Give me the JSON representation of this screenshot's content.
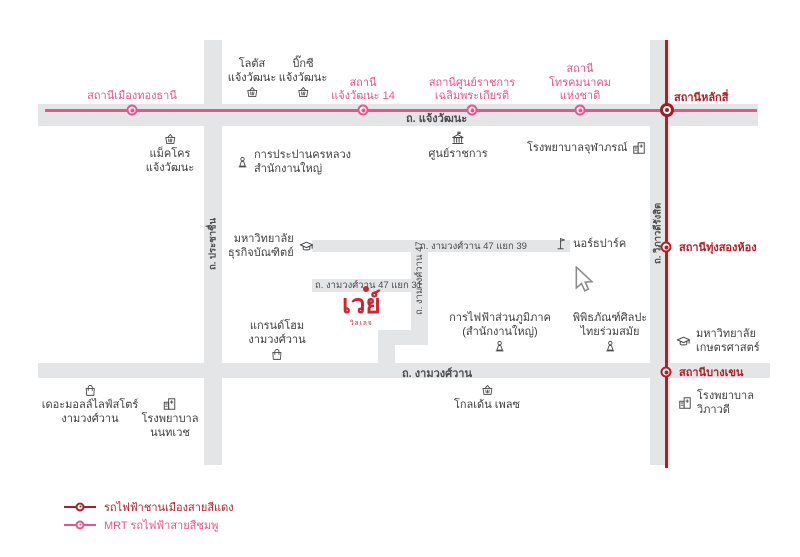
{
  "colors": {
    "pink_line": "#e8538c",
    "red_line": "#b01f28",
    "logo_red": "#d2232e",
    "road_gray": "#e4e5e7",
    "place_text": "#3d3d3d"
  },
  "logo": {
    "text": "เวย์",
    "subtext": "วิลเลจ"
  },
  "roads": {
    "chaengwattana": "ถ. แจ้งวัฒนะ",
    "prachachuen": "ถ. ประชาชื่น",
    "vibhavadi": "ถ. วิภาวดีรังสิต",
    "ngamwongwan": "ถ. งามวงศ์วาน",
    "ngamwongwan47": "ถ. งามวงศ์วาน 47",
    "ngamwongwan47_yaek39": "ถ. งามวงศ์วาน 47 แยก 39",
    "ngamwongwan47_yaek31": "ถ. งามวงศ์วาน 47 แยก 31"
  },
  "transit": {
    "pink_line_stations": [
      {
        "id": "muang-thong-thani",
        "lines": [
          "สถานีเมืองทองธานี"
        ]
      },
      {
        "id": "chaengwattana-14",
        "lines": [
          "สถานี",
          "แจ้งวัฒนะ 14"
        ]
      },
      {
        "id": "government-complex",
        "lines": [
          "สถานีศูนย์ราชการ",
          "เฉลิมพระเกียรติ"
        ]
      },
      {
        "id": "telecom-national",
        "lines": [
          "สถานี",
          "โทรคมนาคม",
          "แห่งชาติ"
        ]
      }
    ],
    "interchange_station": {
      "id": "lak-si",
      "label": "สถานีหลักสี่"
    },
    "red_line_stations": [
      {
        "id": "thung-song-hong",
        "label": "สถานีทุ่งสองห้อง"
      },
      {
        "id": "bang-khen",
        "label": "สถานีบางเขน"
      }
    ]
  },
  "places": [
    {
      "id": "lotus",
      "icon": "shopping-basket",
      "lines": [
        "โลตัส",
        "แจ้งวัฒนะ"
      ]
    },
    {
      "id": "bigc",
      "icon": "shopping-basket",
      "lines": [
        "บิ๊กซี",
        "แจ้งวัฒนะ"
      ]
    },
    {
      "id": "makro",
      "icon": "shopping-basket",
      "lines": [
        "แม็คโคร",
        "แจ้งวัฒนะ"
      ]
    },
    {
      "id": "mwa",
      "icon": "landmark",
      "lines": [
        "การประปานครหลวง",
        "สำนักงานใหญ่"
      ]
    },
    {
      "id": "government-center",
      "icon": "government-building",
      "lines": [
        "ศูนย์ราชการ"
      ]
    },
    {
      "id": "chulabhorn-hospital",
      "icon": "hospital",
      "lines": [
        "โรงพยาบาลจุฬาภรณ์"
      ]
    },
    {
      "id": "dpu",
      "icon": "graduation-cap",
      "lines": [
        "มหาวิทยาลัย",
        "ธุรกิจบัณฑิตย์"
      ]
    },
    {
      "id": "north-park",
      "icon": "flag",
      "lines": [
        "นอร์ธปาร์ค"
      ]
    },
    {
      "id": "grand-home",
      "icon": "shopping-bag",
      "lines": [
        "แกรนด์โฮม",
        "งามวงศ์วาน"
      ]
    },
    {
      "id": "pea",
      "icon": "landmark",
      "lines": [
        "การไฟฟ้าส่วนภูมิภาค",
        "(สำนักงานใหญ่)"
      ]
    },
    {
      "id": "moca",
      "icon": "landmark",
      "lines": [
        "พิพิธภัณฑ์ศิลปะ",
        "ไทยร่วมสมัย"
      ]
    },
    {
      "id": "kasetsart",
      "icon": "graduation-cap",
      "lines": [
        "มหาวิทยาลัย",
        "เกษตรศาสตร์"
      ]
    },
    {
      "id": "the-mall",
      "icon": "shopping-bag",
      "lines": [
        "เดอะมอลล์ไลฟ์สโตร์",
        "งามวงศ์วาน"
      ]
    },
    {
      "id": "nonthavej-hospital",
      "icon": "hospital",
      "lines": [
        "โรงพยาบาล",
        "นนทเวช"
      ]
    },
    {
      "id": "golden-place",
      "icon": "shopping-basket",
      "lines": [
        "โกลเด้น เพลซ"
      ]
    },
    {
      "id": "vibhavadi-hospital",
      "icon": "hospital",
      "lines": [
        "โรงพยาบาล",
        "วิภาวดี"
      ]
    }
  ],
  "legend": [
    {
      "id": "red-line",
      "label": "รถไฟฟ้าชานเมืองสายสีแดง"
    },
    {
      "id": "pink-line",
      "label": "MRT รถไฟฟ้าสายสีชมพู"
    }
  ]
}
